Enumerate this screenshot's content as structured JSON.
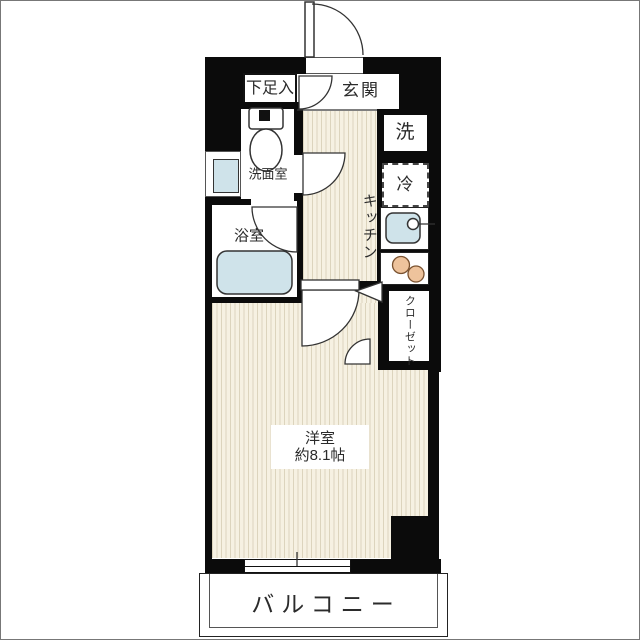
{
  "floorplan": {
    "rooms": {
      "shoe_cabinet": "下足入",
      "entrance": "玄関",
      "washroom": "洗面室",
      "bathroom": "浴室",
      "kitchen": "キッチン",
      "washer": "洗",
      "fridge": "冷",
      "closet": "クローゼット",
      "western_room_label": "洋室",
      "western_room_area": "約8.1帖",
      "balcony": "バルコニー"
    },
    "colors": {
      "wall": "#0b0b0b",
      "floor_bg": "#f6f1e2",
      "floor_line": "#dcd4bd",
      "water": "#cfe3ea",
      "burner": "#eec39c"
    }
  }
}
